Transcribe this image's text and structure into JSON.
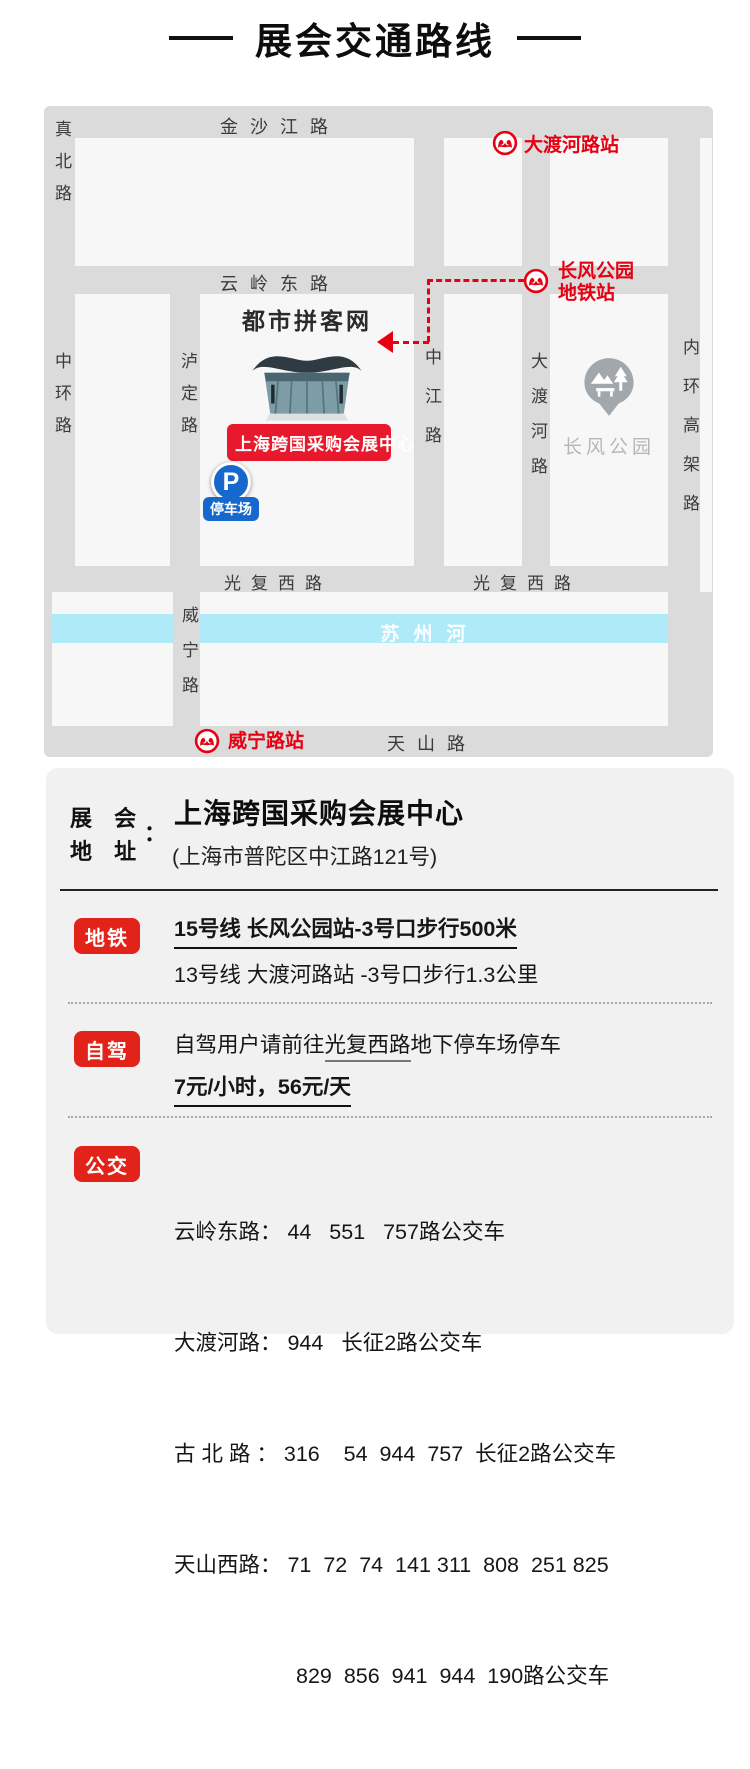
{
  "title": "展会交通路线",
  "map": {
    "roads": {
      "zhenbei": "真北路",
      "jinshajiang": "金沙江路",
      "zhonghuan": "中环路",
      "yunling": "云岭东路",
      "luding": "泸定路",
      "zhongjiang": "中江路",
      "daduhe": "大渡河路",
      "neihuan": "内环高架路",
      "guangfu_left": "光复西路",
      "guangfu_right": "光复西路",
      "weining": "威宁路",
      "tianshan": "天山路"
    },
    "river": "苏州河",
    "stations": {
      "daduhe": "大渡河路站",
      "changfeng_line1": "长风公园",
      "changfeng_line2": "地铁站",
      "weining": "威宁路站"
    },
    "venue": {
      "site_name": "都市拼客网",
      "center_label": "上海跨国采购会展中心",
      "parking_p": "P",
      "parking_label": "停车场"
    },
    "park_label": "长风公园"
  },
  "address": {
    "label_line1": "展 会",
    "label_line2": "地 址",
    "colon": "：",
    "title": "上海跨国采购会展中心",
    "subtitle": "(上海市普陀区中江路121号)"
  },
  "metro": {
    "badge": "地铁",
    "line1": "15号线 长风公园站-3号口步行500米",
    "line2": "13号线 大渡河路站 -3号口步行1.3公里"
  },
  "driving": {
    "badge": "自驾",
    "prefix": "自驾用户请前往",
    "road": "光复西路",
    "suffix": "地下停车场停车",
    "price": "7元/小时，56元/天"
  },
  "bus": {
    "badge": "公交",
    "lines": [
      "云岭东路： 44   551   757路公交车",
      "大渡河路： 944   长征2路公交车",
      "古 北 路 ： 316    54  944  757  长征2路公交车",
      "天山西路： 71  72  74  141 311  808  251 825",
      "829  856  941  944  190路公交车"
    ]
  },
  "colors": {
    "metro_red": "#e60012",
    "badge_red": "#e2231a",
    "venue_red": "#e8192c",
    "river_cyan": "#aeeaf7",
    "parking_blue": "#1668cd",
    "road_gray": "#dbdbdb",
    "block_gray": "#f7f7f7",
    "panel_gray": "#f1f1f1"
  }
}
